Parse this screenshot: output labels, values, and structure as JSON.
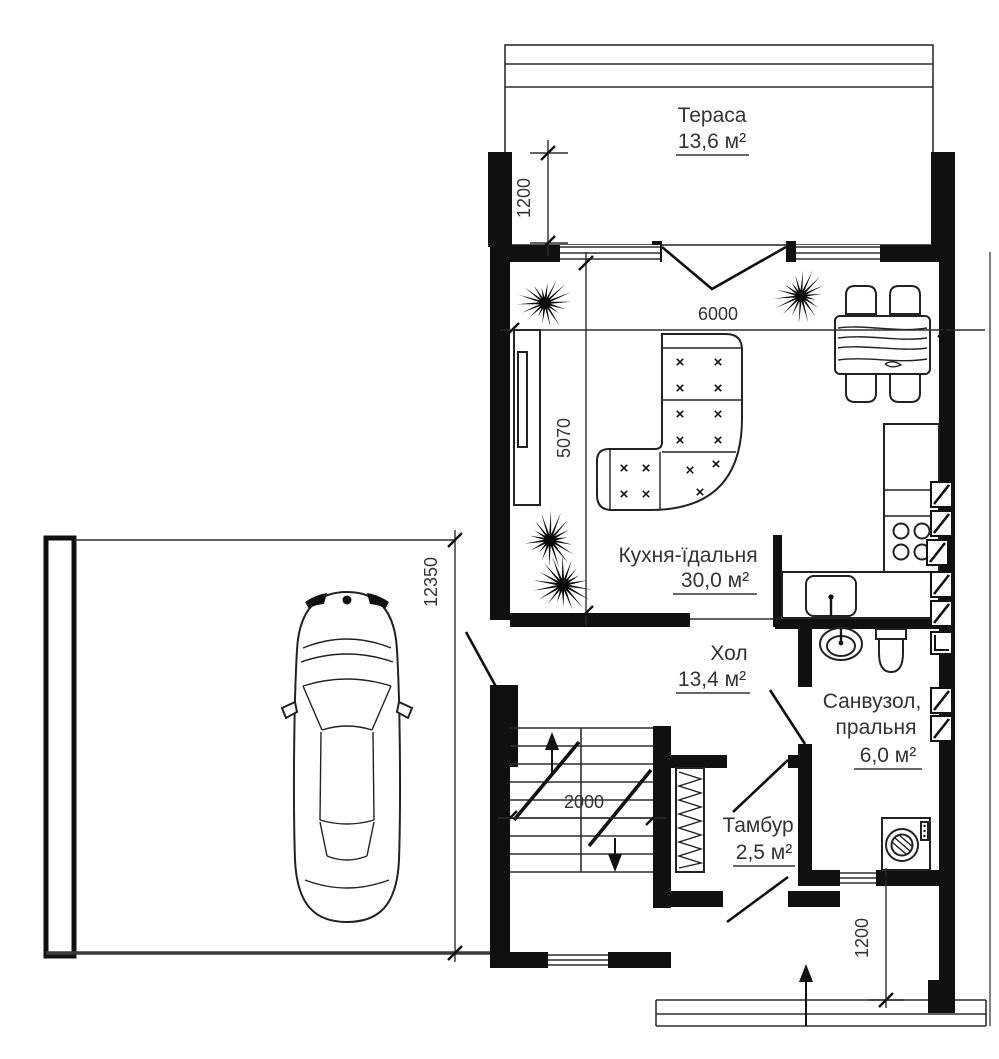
{
  "plan": {
    "type": "floor_plan",
    "rooms": [
      {
        "name": "Тераса",
        "area": "13,6 м²"
      },
      {
        "name": "Кухня-їдальня",
        "area": "30,0 м²"
      },
      {
        "name": "Хол",
        "area": "13,4 м²"
      },
      {
        "name": "Санвузол,",
        "name_line2": "пральня",
        "area": "6,0 м²"
      },
      {
        "name": "Тамбур",
        "area": "2,5 м²"
      }
    ],
    "dimensions": {
      "terrace_depth": "1200",
      "kitchen_width": "6000",
      "kitchen_depth": "5070",
      "side_length": "12350",
      "stair_width": "2000",
      "entry_depth": "1200"
    }
  }
}
